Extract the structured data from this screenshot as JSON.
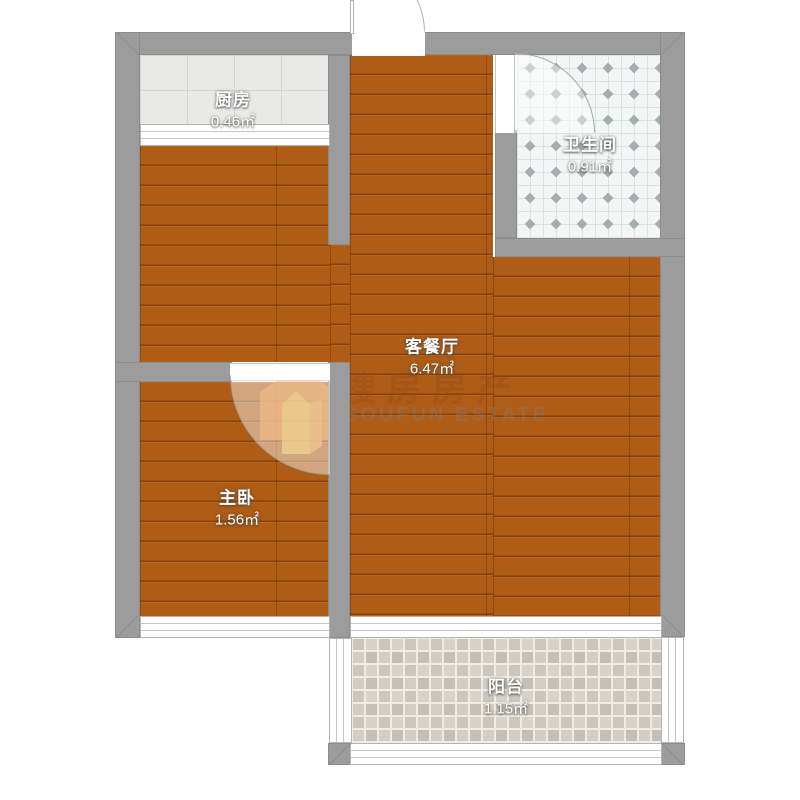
{
  "floorplan": {
    "rooms": [
      {
        "id": "kitchen",
        "name": "厨房",
        "area": "0.46㎡"
      },
      {
        "id": "bathroom",
        "name": "卫生间",
        "area": "0.91㎡"
      },
      {
        "id": "living_dining",
        "name": "客餐厅",
        "area": "6.47㎡"
      },
      {
        "id": "master_bedroom",
        "name": "主卧",
        "area": "1.56㎡"
      },
      {
        "id": "balcony",
        "name": "阳台",
        "area": "1.15㎡"
      }
    ],
    "watermark": {
      "text_cn": "搜房房产",
      "text_en": "SOUFUN ESTATE"
    },
    "colors": {
      "wall": "#9c9c9c",
      "wood_floor": "#ae5c16",
      "kitchen_tile": "#e9e9e7",
      "bathroom_tile": "#f2f6f5",
      "balcony_mosaic": "#d2ccc3",
      "logo_orange": "#ef8a25",
      "logo_yellow": "#f6c33c"
    }
  }
}
